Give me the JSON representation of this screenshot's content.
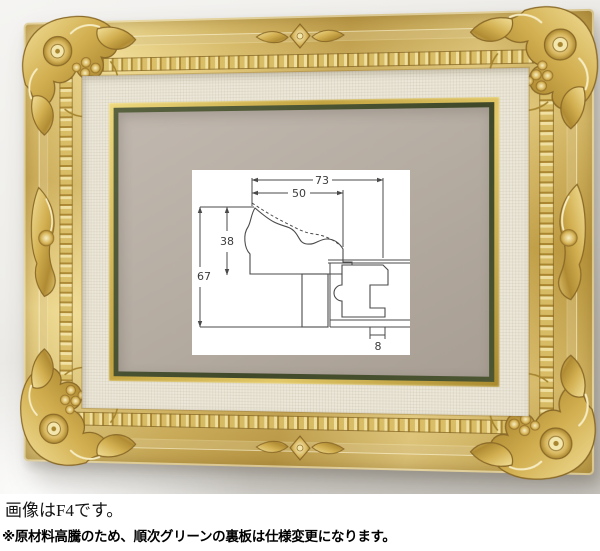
{
  "caption": {
    "line1": "画像はF4です。",
    "line2": "※原材料高騰のため、順次グリーンの裏板は仕様変更になります。"
  },
  "diagram": {
    "labels": {
      "overall_width_mm": "73",
      "face_width_mm": "50",
      "face_height_mm": "38",
      "overall_height_mm": "67",
      "back_lip_mm": "8"
    }
  },
  "colors": {
    "frame_gold": "#d6b45a",
    "frame_gold_light": "#f0dd9c",
    "frame_gold_dark": "#a7832f",
    "liner_cream": "#ece7d8",
    "fillet_gold": "#d8c468",
    "inner_green_line": "#4c5434",
    "backboard_taupe": "#b6ada3",
    "wall_gray": "#e9e7e3",
    "diagram_line": "#4a4a4a",
    "diagram_bg": "#ffffff"
  }
}
